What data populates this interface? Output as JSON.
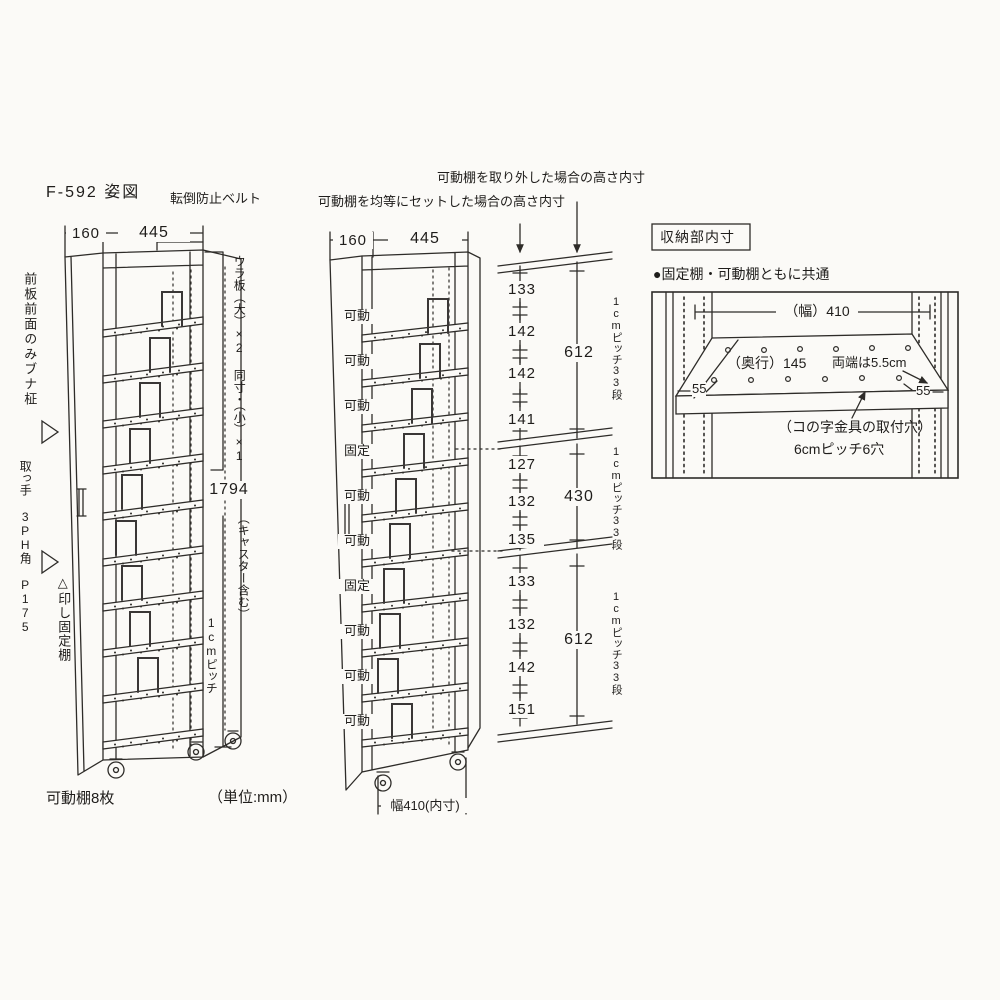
{
  "unit_note": "（単位:mm）",
  "left_view": {
    "title": "F-592 姿図",
    "belt_note": "転倒防止ベルト",
    "dim_depth": "160",
    "dim_width": "445",
    "front_board_note": "前板前面のみブナ柾",
    "handle_note": "取っ手 3PH角 P175",
    "fixed_mark_note": "△印し固定棚",
    "back_panel_note": "ウラ板（大）×2 同寸・（小）×1",
    "dim_height": "1794",
    "height_note": "（キャスター含む）",
    "pitch_note": "1cmピッチ",
    "movable_count_note": "可動棚8枚"
  },
  "middle_view": {
    "note_removed": "可動棚を取り外した場合の高さ内寸",
    "note_equal": "可動棚を均等にセットした場合の高さ内寸",
    "dim_depth": "160",
    "dim_width": "445",
    "shelf_labels": [
      "可動",
      "可動",
      "可動",
      "固定",
      "可動",
      "可動",
      "固定",
      "可動",
      "可動",
      "可動"
    ],
    "bottom_dim": "幅410(内寸)",
    "sections": [
      {
        "segments": [
          "133",
          "142",
          "142",
          "141"
        ],
        "total": "612",
        "pitch": "1cmピッチ33段"
      },
      {
        "segments": [
          "127",
          "132",
          "135"
        ],
        "total": "430",
        "pitch": "1cmピッチ33段"
      },
      {
        "segments": [
          "133",
          "132",
          "142",
          "151"
        ],
        "total": "612",
        "pitch": "1cmピッチ33段"
      }
    ]
  },
  "detail_view": {
    "title": "収納部内寸",
    "subtitle": "●固定棚・可動棚ともに共通",
    "width_dim": "（幅）410",
    "depth_dim": "（奥行）145",
    "ends_note": "両端は5.5cm",
    "left_end_dim": "55",
    "right_end_dim": "55",
    "holes_note_line1": "（コの字金具の取付穴）",
    "holes_note_line2": "6cmピッチ6穴"
  },
  "colors": {
    "ink": "#2e2c29",
    "paper": "#fbfaf7"
  }
}
